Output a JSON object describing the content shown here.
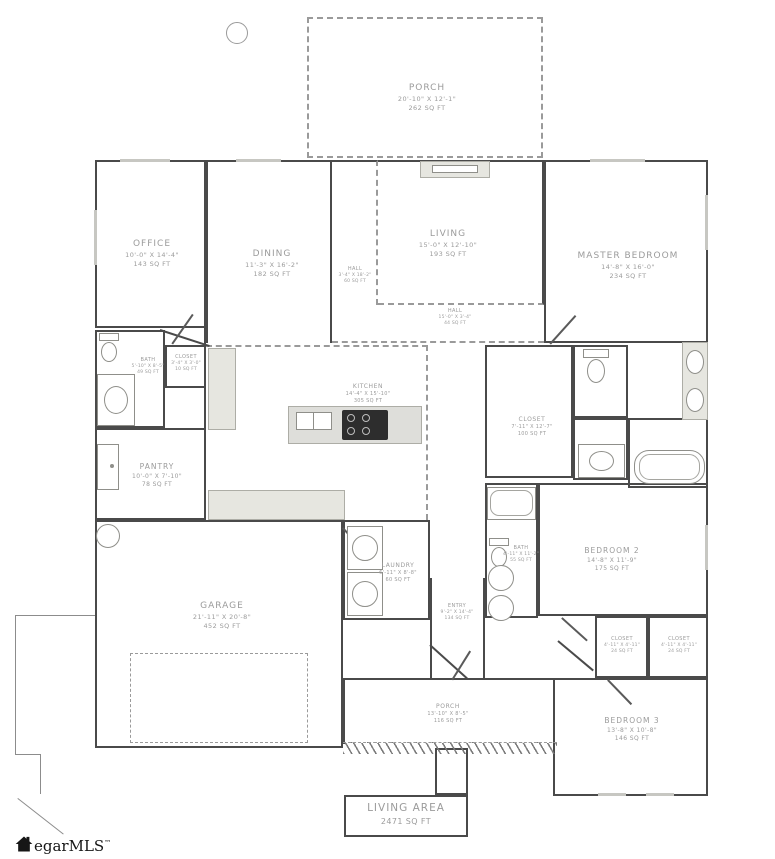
{
  "rooms": {
    "porch_top": {
      "name": "PORCH",
      "dims": "20'-10\" X 12'-1\"",
      "area": "262 SQ FT"
    },
    "office": {
      "name": "OFFICE",
      "dims": "10'-0\" X 14'-4\"",
      "area": "143 SQ FT"
    },
    "dining": {
      "name": "DINING",
      "dims": "11'-3\" X 16'-2\"",
      "area": "182 SQ FT"
    },
    "living": {
      "name": "LIVING",
      "dims": "15'-0\" X 12'-10\"",
      "area": "193 SQ FT"
    },
    "hall_v": {
      "name": "HALL",
      "dims": "3'-4\" X 18'-2\"",
      "area": "60 SQ FT"
    },
    "hall_h": {
      "name": "HALL",
      "dims": "15'-0\" X 3'-4\"",
      "area": "44 SQ FT"
    },
    "master": {
      "name": "MASTER BEDROOM",
      "dims": "14'-8\" X 16'-0\"",
      "area": "234 SQ FT"
    },
    "bath_left": {
      "name": "BATH",
      "dims": "5'-10\" X 8'-5\"",
      "area": "49 SQ FT"
    },
    "closet_small": {
      "name": "CLOSET",
      "dims": "3'-4\" X 3'-0\"",
      "area": "10 SQ FT"
    },
    "kitchen": {
      "name": "KITCHEN",
      "dims": "14'-4\" X 15'-10\"",
      "area": "305 SQ FT"
    },
    "master_closet": {
      "name": "CLOSET",
      "dims": "7'-11\" X 12'-7\"",
      "area": "100 SQ FT"
    },
    "pantry": {
      "name": "PANTRY",
      "dims": "10'-0\" X 7'-10\"",
      "area": "78 SQ FT"
    },
    "garage": {
      "name": "GARAGE",
      "dims": "21'-11\" X 20'-8\"",
      "area": "452 SQ FT"
    },
    "laundry": {
      "name": "LAUNDRY",
      "dims": "6'-11\" X 8'-8\"",
      "area": "60 SQ FT"
    },
    "bath_center": {
      "name": "BATH",
      "dims": "4'-11\" X 11'-2\"",
      "area": "55 SQ FT"
    },
    "entry": {
      "name": "ENTRY",
      "dims": "9'-2\" X 14'-4\"",
      "area": "134 SQ FT"
    },
    "bedroom2": {
      "name": "BEDROOM 2",
      "dims": "14'-8\" X 11'-9\"",
      "area": "175 SQ FT"
    },
    "closet_b2": {
      "name": "CLOSET",
      "dims": "4'-11\" X 4'-11\"",
      "area": "24 SQ FT"
    },
    "porch_bottom": {
      "name": "PORCH",
      "dims": "13'-10\" X 8'-5\"",
      "area": "116 SQ FT"
    },
    "bedroom3": {
      "name": "BEDROOM 3",
      "dims": "13'-8\" X 10'-8\"",
      "area": "146 SQ FT"
    }
  },
  "living_area": {
    "name": "LIVING AREA",
    "area": "2471 SQ FT"
  },
  "logo": {
    "text": "egarMLS",
    "tm": "TM"
  },
  "colors": {
    "wall": "#4a4a4a",
    "dashed": "#9a9a9a",
    "label": "#9b9b9b",
    "fixture": "#e6e6e0"
  }
}
